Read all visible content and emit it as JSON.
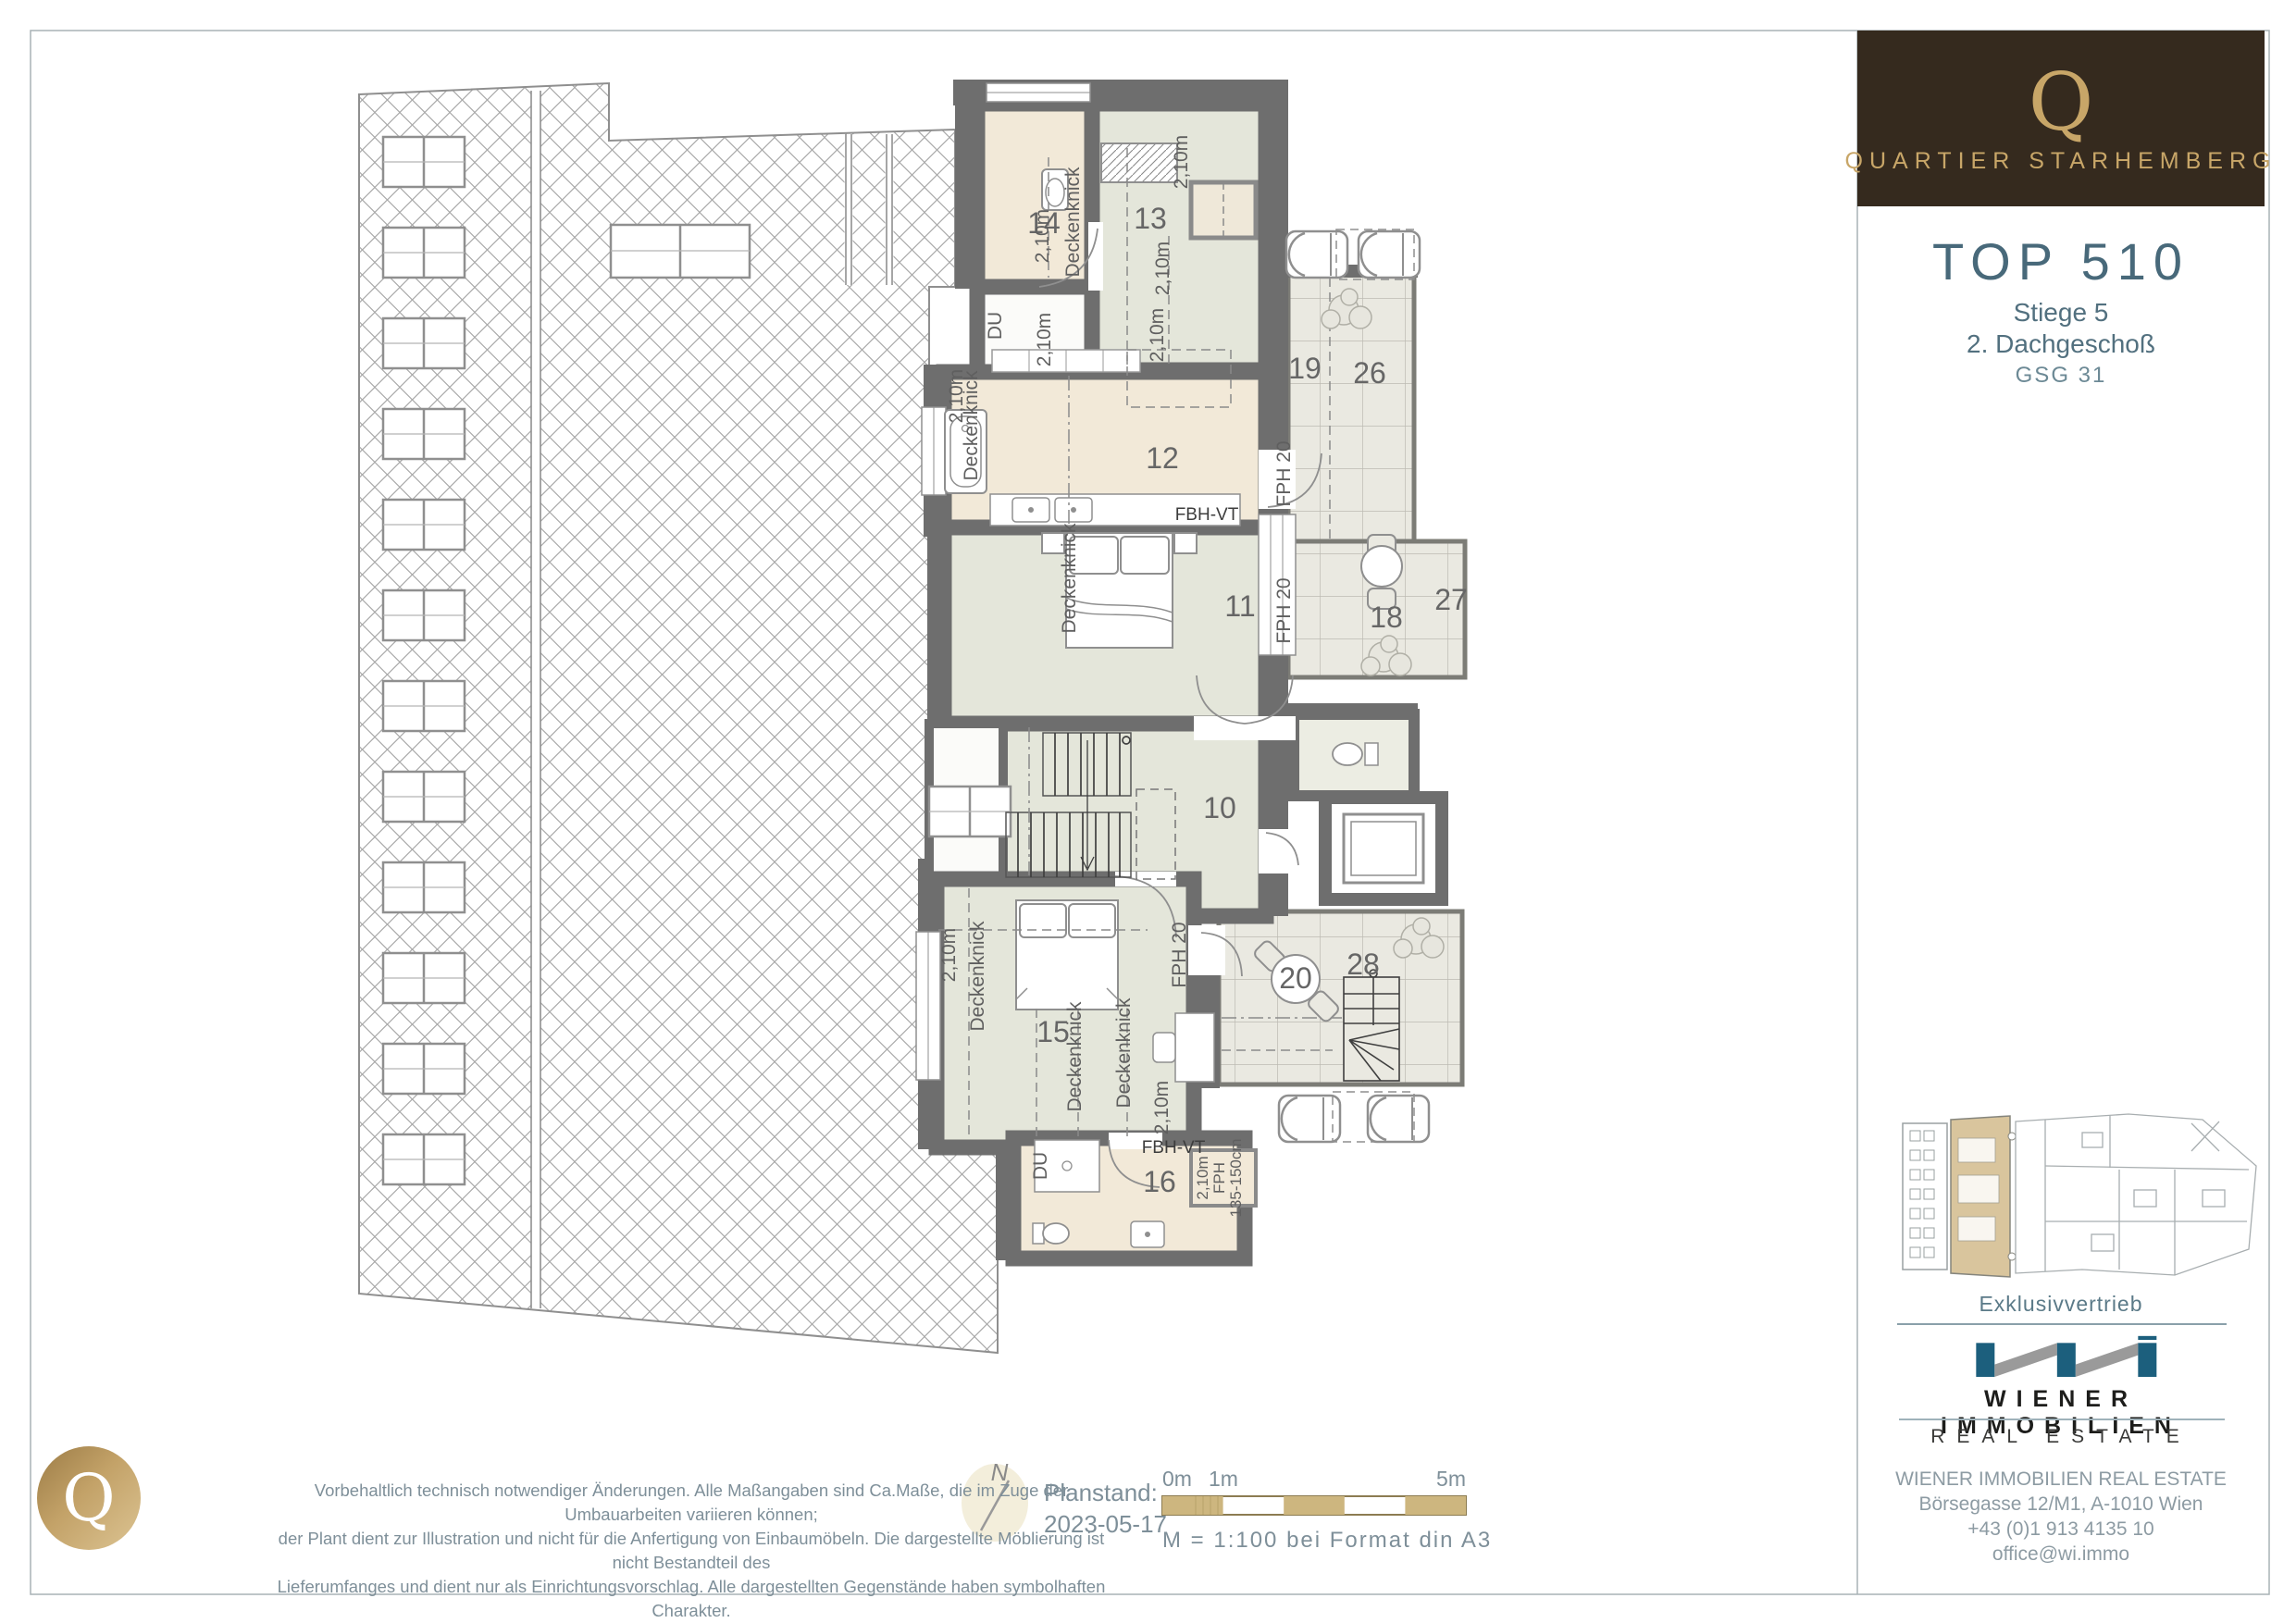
{
  "brand": {
    "logo_letter": "Q",
    "name": "QUARTIER STARHEMBERG"
  },
  "unit": {
    "title": "TOP 510",
    "stiege": "Stiege 5",
    "floor": "2. Dachgeschoß",
    "code": "GSG 31"
  },
  "plan": {
    "rooms": {
      "r10": "10",
      "r11": "11",
      "r12": "12",
      "r13": "13",
      "r14": "14",
      "r15": "15",
      "r16": "16",
      "r18": "18",
      "r19": "19",
      "r20": "20",
      "r26": "26",
      "r27": "27",
      "r28": "28"
    },
    "tags": {
      "height": "2,10m",
      "deckenknick": "Deckenknick",
      "fph20": "FPH 20",
      "fbhvt": "FBH-VT",
      "du": "DU",
      "fph": "FPH",
      "fph_range": "135-150cm"
    }
  },
  "footer": {
    "disclaimer_lines": [
      "Vorbehaltlich technisch notwendiger Änderungen. Alle Maßangaben sind Ca.Maße, die im Zuge der Umbauarbeiten variieren können;",
      "der Plant dient zur Illustration und nicht für die Anfertigung von Einbaumöbeln. Die dargestellte Möblierung ist nicht Bestandteil des",
      "Lieferumfanges und dient nur als Einrichtungsvorschlag. Alle dargestellten Gegenstände haben symbolhaften Charakter."
    ],
    "scale": {
      "tick0": "0m",
      "tick1": "1m",
      "tick5": "5m",
      "caption": "M = 1:100 bei Format din A3"
    },
    "north_label": "N",
    "planstand_label": "Planstand:",
    "planstand_date": "2023-05-17"
  },
  "distributor": {
    "heading": "Exklusivvertrieb",
    "brand_line1": "WIENER IMMOBILIEN",
    "brand_line2": "REAL ESTATE",
    "contact_lines": [
      "WIENER IMMOBILIEN REAL ESTATE",
      "Börsegasse 12/M1, A-1010 Wien",
      "+43 (0)1 913 4135 10",
      "office@wi.immo"
    ]
  },
  "colors": {
    "accent_gold": "#c8a668",
    "brand_bg": "#352a1e",
    "heading_blue": "#48697a",
    "wi_blue": "#1c5f7d",
    "wall_gray": "#6e6e6e",
    "bath_beige": "#f2e9d8",
    "room_sage": "#e4e6da",
    "terrace_tile": "#eae9e1",
    "scale_tan": "#cdb67f"
  }
}
